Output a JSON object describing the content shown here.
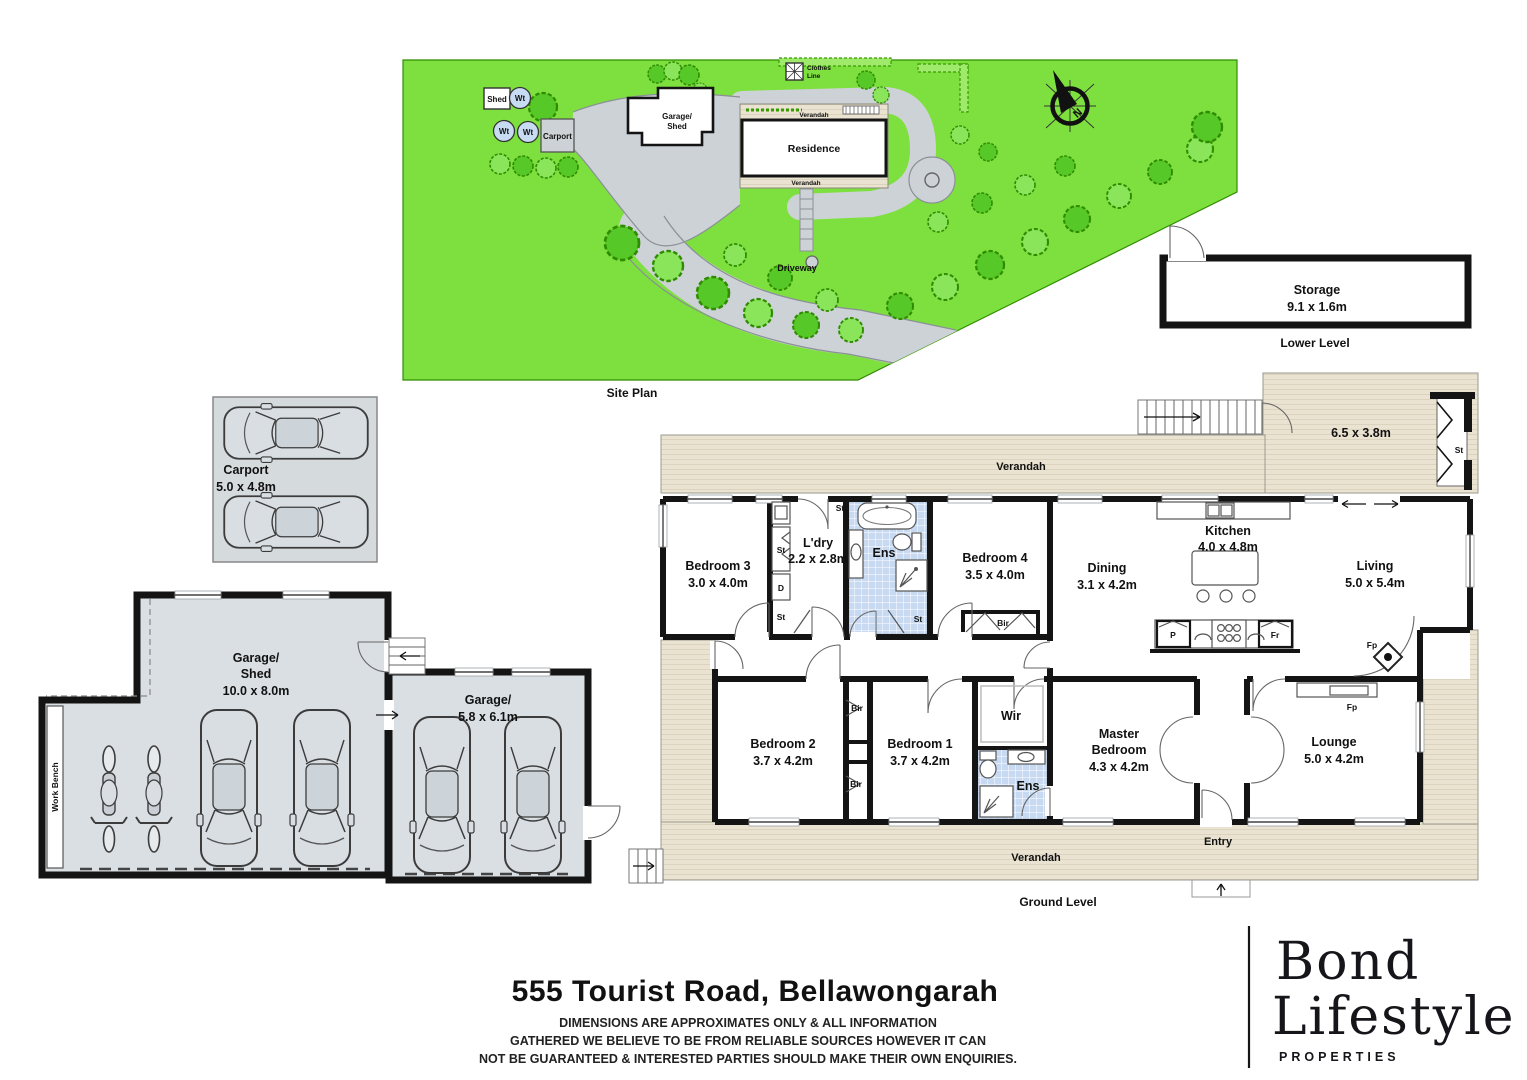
{
  "colors": {
    "grass": "#7EE03E",
    "tree_dark": "#56C827",
    "tree_light": "#8BE55A",
    "tree_stroke": "#2F8C00",
    "driveway": "#CDD2D6",
    "verandah": "#EAE3D2",
    "verandah_stripe": "#DCD3BE",
    "wall": "#141414",
    "tile_blue": "#C7DAF2",
    "garage_floor": "#DADFE3",
    "water_tank": "#C7DCF2"
  },
  "site_plan": {
    "title": "Site Plan",
    "shed_label": "Shed",
    "wt_label": "Wt",
    "carport_label": "Carport",
    "garage_name1": "Garage/",
    "garage_name2": "Shed",
    "residence_label": "Residence",
    "verandah_label": "Verandah",
    "clothes1": "Clothes",
    "clothes2": "Line",
    "driveway_label": "Driveway",
    "compass_n": "N"
  },
  "storage": {
    "name": "Storage",
    "size": "9.1 x 1.6m",
    "level_label": "Lower Level"
  },
  "carport": {
    "name": "Carport",
    "size": "5.0 x 4.8m"
  },
  "garage_shed": {
    "name1": "Garage/",
    "name2": "Shed",
    "size": "10.0 x 8.0m",
    "work_bench": "Work Bench"
  },
  "garage": {
    "name": "Garage/",
    "size": "5.8 x 6.1m"
  },
  "ground": {
    "level_label": "Ground Level",
    "verandah_label": "Verandah",
    "verandah_size": "6.5 x 3.8m",
    "entry_label": "Entry",
    "rooms": {
      "bedroom3": {
        "name": "Bedroom 3",
        "size": "3.0 x 4.0m"
      },
      "ldry": {
        "name": "L'dry",
        "size": "2.2 x 2.8m"
      },
      "ens": {
        "name": "Ens"
      },
      "bedroom4": {
        "name": "Bedroom 4",
        "size": "3.5 x 4.0m"
      },
      "dining": {
        "name": "Dining",
        "size": "3.1 x 4.2m"
      },
      "kitchen": {
        "name": "Kitchen",
        "size": "4.0 x 4.8m"
      },
      "living": {
        "name": "Living",
        "size": "5.0 x 5.4m"
      },
      "bedroom2": {
        "name": "Bedroom 2",
        "size": "3.7 x 4.2m"
      },
      "bedroom1": {
        "name": "Bedroom 1",
        "size": "3.7 x 4.2m"
      },
      "wir": {
        "name": "Wir"
      },
      "ens2": {
        "name": "Ens"
      },
      "master": {
        "name1": "Master",
        "name2": "Bedroom",
        "size": "4.3 x 4.2m"
      },
      "lounge": {
        "name": "Lounge",
        "size": "5.0 x 4.2m"
      }
    },
    "abbr": {
      "st": "St",
      "d": "D",
      "bir": "Bir",
      "p": "P",
      "fr": "Fr",
      "fp": "Fp"
    }
  },
  "footer": {
    "address": "555 Tourist Road, Bellawongarah",
    "line1": "DIMENSIONS ARE APPROXIMATES ONLY & ALL INFORMATION",
    "line2": "GATHERED WE BELIEVE TO BE FROM RELIABLE SOURCES HOWEVER IT CAN",
    "line3": "NOT BE GUARANTEED & INTERESTED PARTIES SHOULD MAKE THEIR OWN ENQUIRIES."
  },
  "logo": {
    "line1": "Bond",
    "line2": "Lifestyle",
    "line3": "PROPERTIES"
  }
}
